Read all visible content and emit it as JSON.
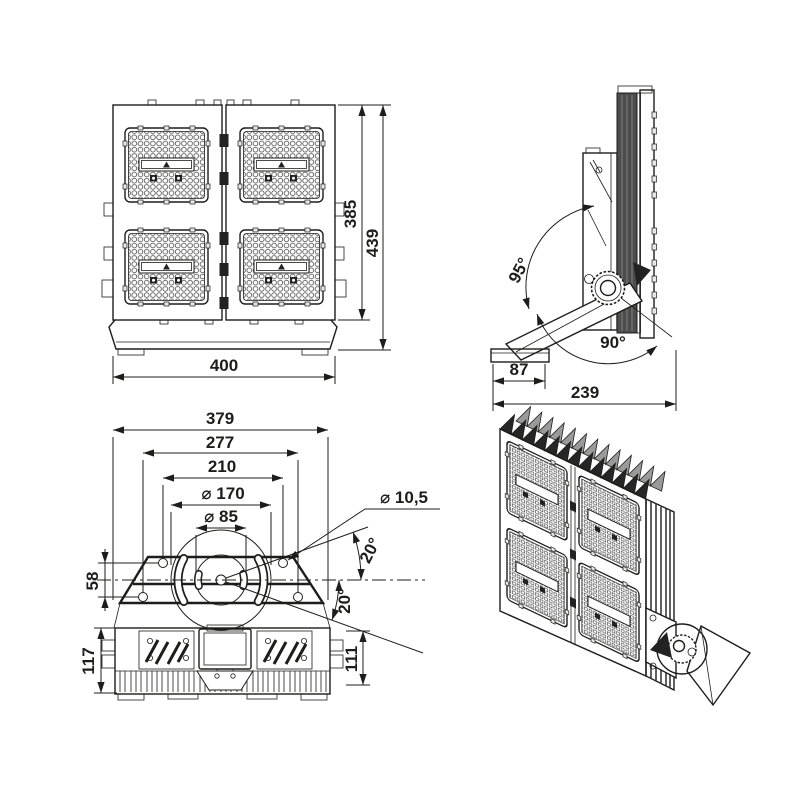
{
  "drawing": {
    "background": "#ffffff",
    "line_color": "#1d1d1b",
    "heatsink_fill": "#4d4d4d",
    "views": {
      "front": {
        "width": "400",
        "body_height": "385",
        "total_height": "439"
      },
      "side": {
        "swivel_up_angle": "95°",
        "swivel_down_angle": "90°",
        "base_width": "87",
        "total_depth": "239"
      },
      "bottom": {
        "total_width": "379",
        "mount_holes_outer": "277",
        "mount_holes_inner": "210",
        "bolt_circle_outer": "⌀ 170",
        "bolt_circle_inner": "⌀ 85",
        "mount_hole_diameter": "⌀ 10,5",
        "angle_up": "20°",
        "angle_down": "20°",
        "hole_row_offset": "58",
        "height_left": "117",
        "height_right": "111"
      }
    }
  }
}
